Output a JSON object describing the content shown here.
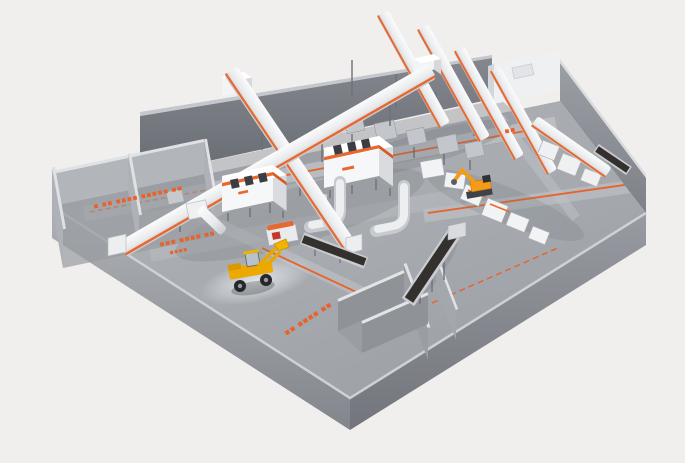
{
  "scene": {
    "kind": "3d-plant-layout-render",
    "colors": {
      "background": "#f0efed",
      "floor": "#a7abb0",
      "floor_lane_light": "#c2c5c9",
      "wall_dark": "#73777e",
      "wall_light": "#b2b5ba",
      "machine_white": "#f6f7f8",
      "machine_side": "#d9dbdf",
      "accent_orange": "#e8622a",
      "belt_dark": "#34302d",
      "loader_yellow": "#eda900",
      "handler_orange": "#f59b18"
    },
    "floor_labels": [
      {
        "id": "left-lane-label",
        "text": "■ ■■ ■■■■ ■■■■■ ■■"
      },
      {
        "id": "left-bay-label-1",
        "text": "■■■ ■■■■ ■■"
      },
      {
        "id": "left-bay-label-2",
        "text": "■■■■"
      },
      {
        "id": "bottom-bay-label",
        "text": "■■ ■■■■ ■■"
      },
      {
        "id": "upper-lane-dash",
        "text": "■■"
      }
    ],
    "equipment": [
      "perimeter-wall",
      "storage-bays",
      "lane-markings",
      "crossing-conveyor-tube",
      "inclined-conveyor-fan",
      "machine-cabin",
      "duct-elbow",
      "processing-line",
      "material-handler",
      "belt-conveyor",
      "wheel-loader"
    ]
  }
}
